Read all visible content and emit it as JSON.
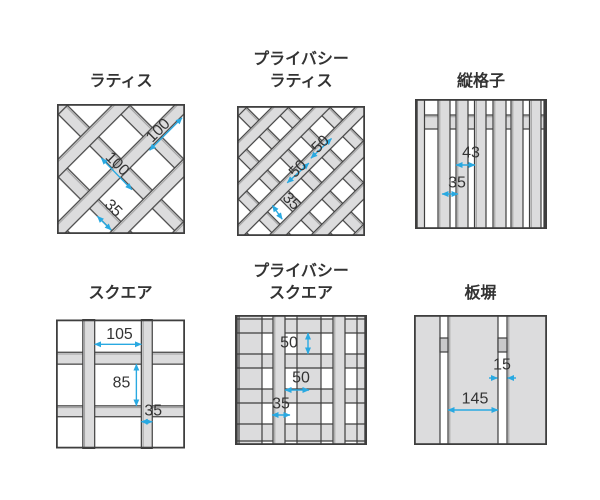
{
  "page": {
    "background": "#ffffff"
  },
  "colors": {
    "dimension_line": "#29a9e1",
    "wood_light": "#dcdcdd",
    "wood_shade": "#c9c9ca",
    "outline": "#3e3e3e",
    "bevel": "#9e9e9e",
    "label_text": "#333333"
  },
  "panels": [
    {
      "id": "lattice",
      "title_lines": [
        "ラティス"
      ],
      "dims": [
        {
          "label": "100"
        },
        {
          "label": "100"
        },
        {
          "label": "35"
        }
      ]
    },
    {
      "id": "privacy-lattice",
      "title_lines": [
        "プライバシー",
        "ラティス"
      ],
      "dims": [
        {
          "label": "50"
        },
        {
          "label": "50"
        },
        {
          "label": "35"
        }
      ]
    },
    {
      "id": "vertical-slat",
      "title_lines": [
        "縦格子"
      ],
      "dims": [
        {
          "label": "43"
        },
        {
          "label": "35"
        }
      ]
    },
    {
      "id": "square",
      "title_lines": [
        "スクエア"
      ],
      "dims": [
        {
          "label": "105"
        },
        {
          "label": "85"
        },
        {
          "label": "35"
        }
      ]
    },
    {
      "id": "privacy-square",
      "title_lines": [
        "プライバシー",
        "スクエア"
      ],
      "dims": [
        {
          "label": "50"
        },
        {
          "label": "50"
        },
        {
          "label": "35"
        }
      ]
    },
    {
      "id": "board-fence",
      "title_lines": [
        "板塀"
      ],
      "dims": [
        {
          "label": "15"
        },
        {
          "label": "145"
        }
      ]
    }
  ]
}
